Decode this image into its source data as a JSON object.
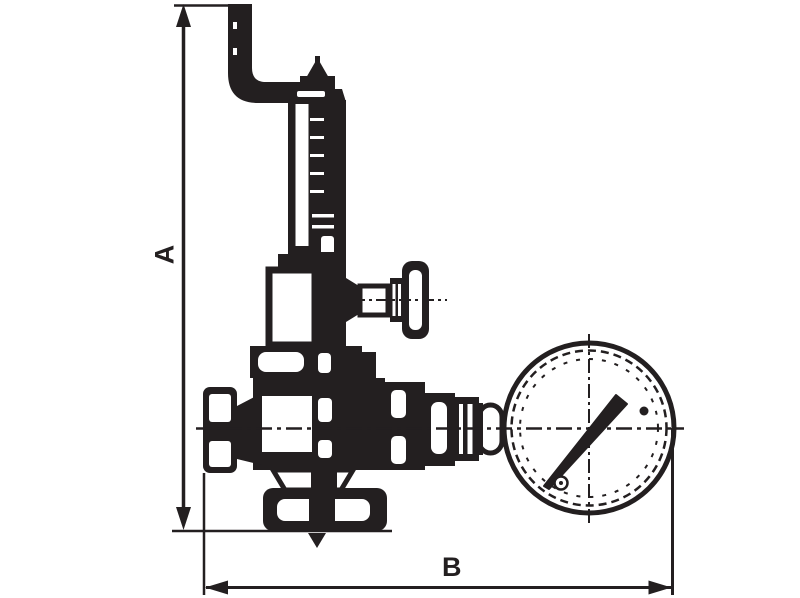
{
  "drawing": {
    "kind": "dimensioned technical line drawing of a bronze safety/reducing valve with exhaust pipe, side handwheel and pressure gauge",
    "background_color": "#ffffff",
    "line_color": "#231f20",
    "dimension_labels": {
      "height": "A",
      "width": "B"
    },
    "components": [
      "dimension-line-a-vertical",
      "dimension-line-b-horizontal",
      "exhaust-elbow-pipe",
      "adjusting-screw-tip",
      "spring-bonnet-column",
      "spring-housing",
      "side-handwheel",
      "body-flange",
      "valve-body",
      "inlet-cap",
      "gauge-coupling-fittings",
      "pressure-gauge-dial",
      "gauge-needle",
      "drain-outlet",
      "downward-flow-arrow",
      "dash-dot-centerlines"
    ]
  }
}
